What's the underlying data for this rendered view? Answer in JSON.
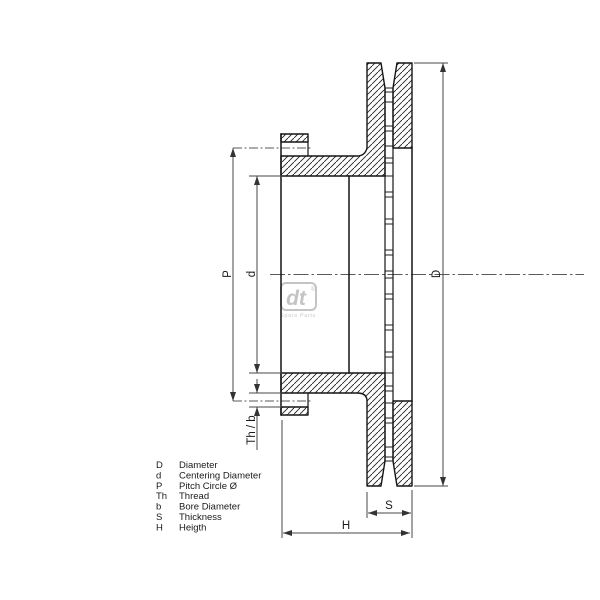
{
  "drawing": {
    "dimension_labels": {
      "outer_diameter": "D",
      "centering_diameter": "d",
      "pitch_circle": "P",
      "thread_bore": "Th / b",
      "thickness": "S",
      "height": "H"
    },
    "legend": [
      {
        "symbol": "D",
        "description": "Diameter"
      },
      {
        "symbol": "d",
        "description": "Centering Diameter"
      },
      {
        "symbol": "P",
        "description": "Pitch Circle Ø"
      },
      {
        "symbol": "Th",
        "description": "Thread"
      },
      {
        "symbol": "b",
        "description": "Bore Diameter"
      },
      {
        "symbol": "S",
        "description": "Thickness"
      },
      {
        "symbol": "H",
        "description": "Heigth"
      }
    ],
    "logo": {
      "text": "dt",
      "registered": "®",
      "subtext": "Spare Parts"
    },
    "colors": {
      "line": "#141414",
      "dimension": "#474747",
      "logo": "#c4c4c4",
      "background": "#ffffff"
    }
  }
}
